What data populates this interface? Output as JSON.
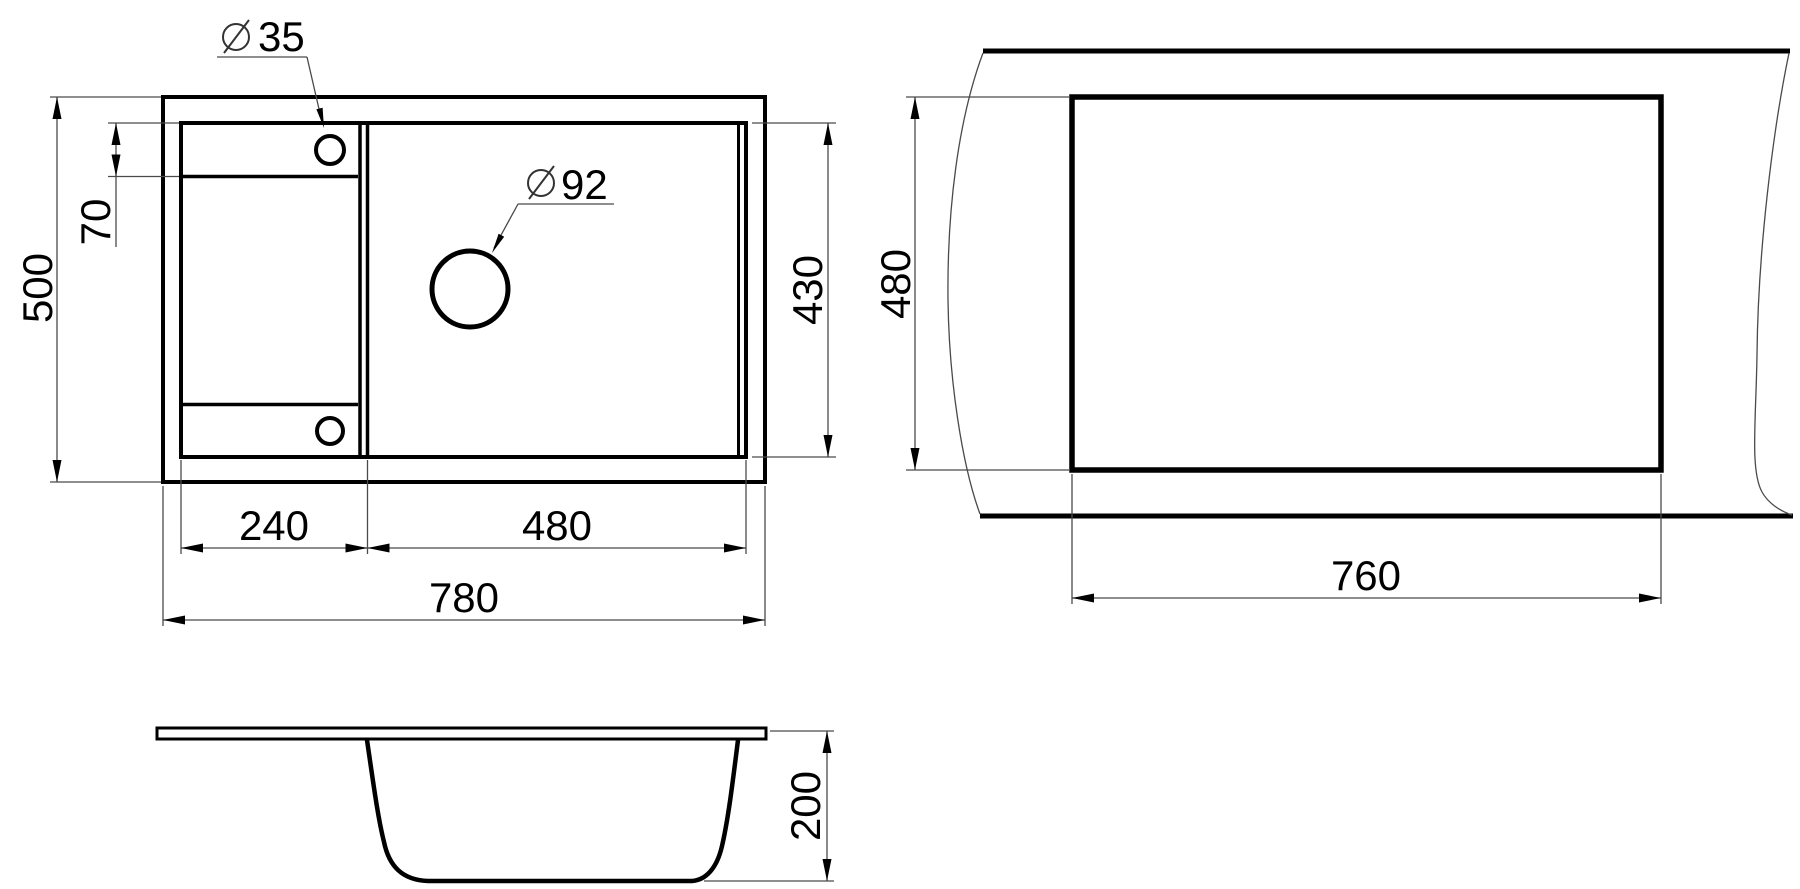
{
  "drawing": {
    "title": "sink-technical-drawing",
    "background": "#ffffff",
    "line_color": "#000000",
    "views": {
      "top_view": "sink top view",
      "cutout_view": "countertop cutout view",
      "section_view": "sink section view"
    },
    "dimensions": {
      "overall_length": "780",
      "overall_width": "500",
      "drainer_section_length": "240",
      "bowl_section_length": "480",
      "tap_hole_offset": "70",
      "inner_width": "430",
      "tap_hole_diameter": {
        "symbol": "⌀",
        "value": "35"
      },
      "drain_hole_diameter": {
        "symbol": "⌀",
        "value": "92"
      },
      "cutout_length": "760",
      "cutout_width": "480",
      "bowl_depth": "200"
    }
  }
}
